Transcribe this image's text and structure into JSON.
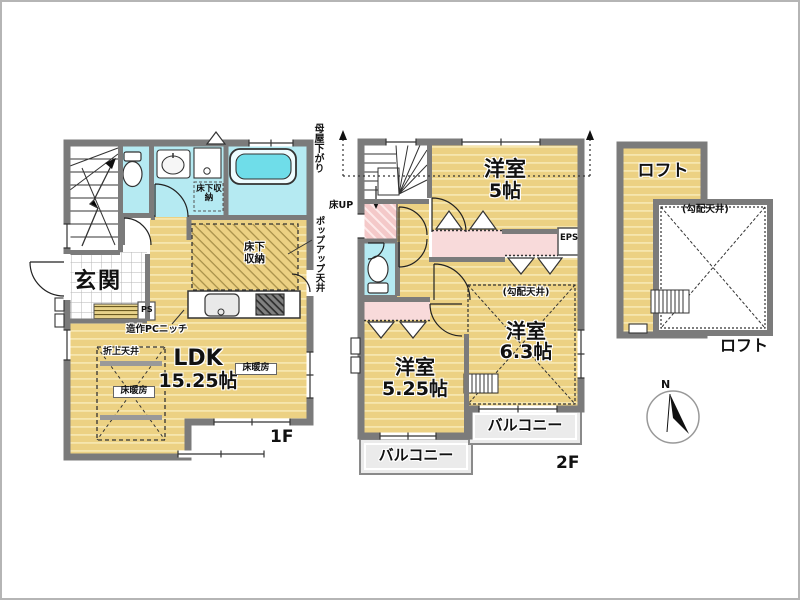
{
  "f1": {
    "floor_label": "1F",
    "genkan_label": "玄関",
    "ldk_name": "LDK",
    "ldk_size": "15.25帖",
    "floor_heating_label": "床暖房",
    "raised_ceiling_label": "折上天井",
    "underfloor_storage_label": "床下収納",
    "niche_label": "造作PCニッチ",
    "ps_label": "PS",
    "popup_ceiling_label": "ポップアップ天井"
  },
  "f2": {
    "floor_label": "2F",
    "room5_name": "洋室",
    "room5_size": "5帖",
    "room525_name": "洋室",
    "room525_size": "5.25帖",
    "room63_name": "洋室",
    "room63_size": "6.3帖",
    "balcony_label": "バルコニー",
    "moyasagari_label": "母屋下がり",
    "floor_up_label": "床UP",
    "eps_label": "EPS",
    "sloped_ceiling_label": "(勾配天井)"
  },
  "loft": {
    "label": "ロフト",
    "sloped_ceiling_label": "(勾配天井)"
  },
  "compass": {
    "north_label": "N"
  },
  "colors": {
    "floor_tan": "#ecd183",
    "floor_stripe": "#f6e6ae",
    "wall_gray": "#7b7b7b",
    "wet_area_cyan": "#b5eaf2",
    "closet_pink": "#f8dada",
    "tub_cyan": "#6fdde9",
    "balcony_gray": "#ebebeb"
  }
}
